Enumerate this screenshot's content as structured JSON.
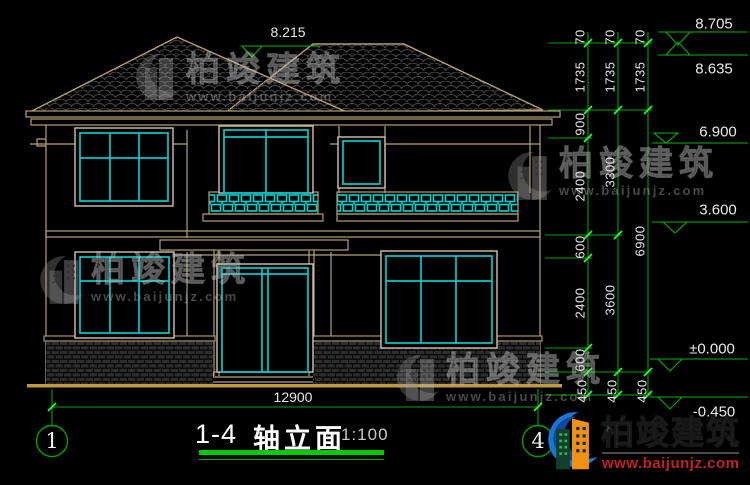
{
  "drawing": {
    "title_axis": "1-4",
    "title_name": "轴立面",
    "title_scale": "1:100",
    "axis_bubble_left": "1",
    "axis_bubble_right": "4",
    "bottom_overall_dimension": "12900",
    "roof_elevation_label": "8.215"
  },
  "elevation_labels": [
    {
      "t": "8.705",
      "x": 714,
      "y": 24
    },
    {
      "t": "8.635",
      "x": 714,
      "y": 69
    },
    {
      "t": "6.900",
      "x": 718,
      "y": 132
    },
    {
      "t": "3.600",
      "x": 718,
      "y": 210
    },
    {
      "t": "±0.000",
      "x": 712,
      "y": 349
    },
    {
      "t": "-0.450",
      "x": 714,
      "y": 412
    }
  ],
  "dimension_labels": [
    {
      "t": "70",
      "x": 580,
      "y": 37
    },
    {
      "t": "1735",
      "x": 580,
      "y": 77
    },
    {
      "t": "900",
      "x": 580,
      "y": 124
    },
    {
      "t": "2400",
      "x": 580,
      "y": 186
    },
    {
      "t": "600",
      "x": 580,
      "y": 247
    },
    {
      "t": "2400",
      "x": 580,
      "y": 303
    },
    {
      "t": "600",
      "x": 580,
      "y": 360
    },
    {
      "t": "450",
      "x": 582,
      "y": 391
    },
    {
      "t": "70",
      "x": 610,
      "y": 37
    },
    {
      "t": "1735",
      "x": 610,
      "y": 77
    },
    {
      "t": "3300",
      "x": 610,
      "y": 172
    },
    {
      "t": "3600",
      "x": 610,
      "y": 300
    },
    {
      "t": "450",
      "x": 612,
      "y": 391
    },
    {
      "t": "70",
      "x": 640,
      "y": 37
    },
    {
      "t": "1735",
      "x": 640,
      "y": 77
    },
    {
      "t": "6900",
      "x": 640,
      "y": 241
    },
    {
      "t": "450",
      "x": 642,
      "y": 391
    }
  ],
  "watermark": {
    "name": "柏竣建筑",
    "url": "www.baijunjz.com"
  },
  "brand_logo": {
    "name": "柏竣建筑",
    "url": "www.baijunjz.com"
  },
  "colors": {
    "dimension_green": "#00a300",
    "tick_green": "#21ff21",
    "cad_tan": "#b4a276",
    "cad_cyan": "#00c9c9",
    "ground_yellow": "#c09a3e",
    "title_underline_green": "#00cc00",
    "brand_red": "#c22323",
    "brand_blue": "#1976d2",
    "brand_orange": "#f29111"
  }
}
